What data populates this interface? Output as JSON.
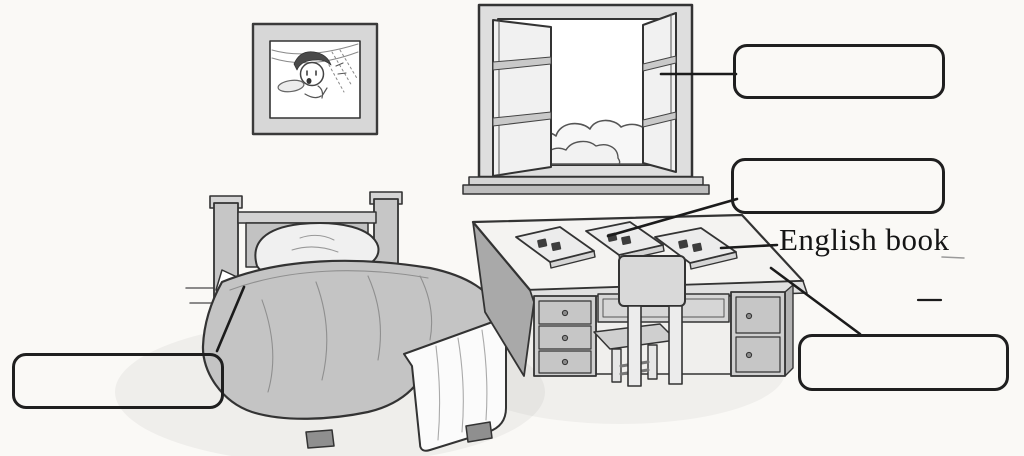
{
  "colors": {
    "ink": "#1f1f1f",
    "paper": "#faf9f6",
    "shade_mid": "#c4c4c4",
    "shade_dark": "#a9a9a9"
  },
  "labels": {
    "english_book": "English book"
  },
  "answer_boxes": [
    {
      "id": "window-box",
      "value": "",
      "points_to": "window"
    },
    {
      "id": "book-box",
      "value": "",
      "points_to": "book-on-desk"
    },
    {
      "id": "desk-box",
      "value": "",
      "points_to": "desk"
    },
    {
      "id": "bed-box",
      "value": "",
      "points_to": "bed"
    }
  ],
  "scene": {
    "items": [
      "picture-frame",
      "window",
      "clouds",
      "bed",
      "pillow",
      "blanket",
      "bed-skirt",
      "desk",
      "desk-drawers",
      "chair",
      "book-1",
      "book-2",
      "english-book"
    ]
  }
}
